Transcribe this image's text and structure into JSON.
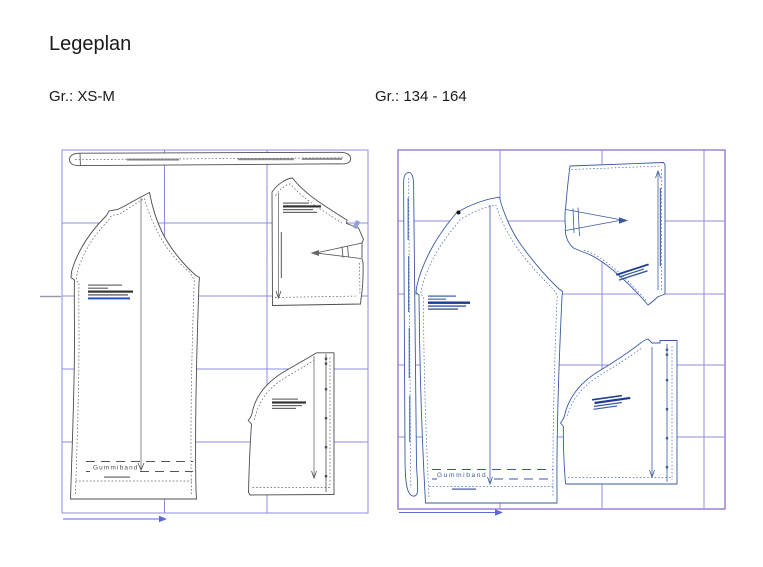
{
  "page": {
    "title": "Legeplan"
  },
  "panels": {
    "left": {
      "size_label": "Gr.: XS-M",
      "gummiband_label": "Gummiband"
    },
    "right": {
      "size_label": "Gr.: 134 - 164",
      "gummiband_label": "Gummiband"
    }
  },
  "colors": {
    "grid_line": "#8d8de0",
    "right_panel_border": "#9678d2",
    "left_piece_outline": "#4d4d4d",
    "right_piece_outline": "#3a5aa0",
    "arrow": "#5f6ad0",
    "text": "#1a1a1a"
  }
}
